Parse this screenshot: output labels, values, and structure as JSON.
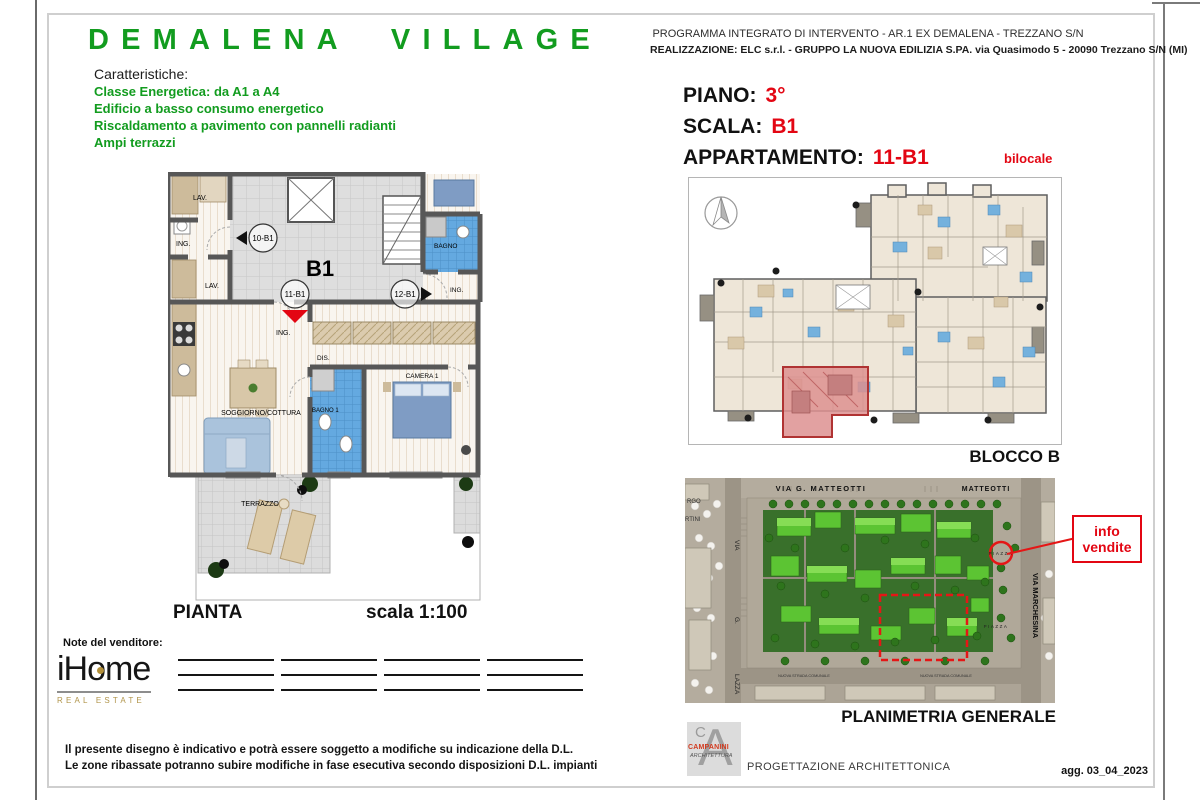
{
  "colors": {
    "brand_green": "#129c1f",
    "accent_red": "#e30613"
  },
  "brand": {
    "title": "DEMALENA VILLAGE",
    "caratteristiche_label": "Caratteristiche:",
    "features": [
      "Classe Energetica: da A1 a A4",
      "Edificio a basso consumo energetico",
      "Riscaldamento a pavimento con pannelli radianti",
      "Ampi terrazzi"
    ]
  },
  "header": {
    "line1": "PROGRAMMA INTEGRATO DI INTERVENTO -  AR.1 EX DEMALENA  - TREZZANO S/N",
    "line2": "REALIZZAZIONE: ELC s.r.l. - GRUPPO LA NUOVA EDILIZIA S.PA. via Quasimodo 5 - 20090 Trezzano S/N (MI)"
  },
  "unit_info": {
    "piano_label": "PIANO:",
    "piano_value": "3°",
    "scala_label": "SCALA:",
    "scala_value": "B1",
    "appartamento_label": "APPARTAMENTO:",
    "appartamento_value": "11-B1",
    "tipologia": "bilocale"
  },
  "floor_plan": {
    "caption": "PIANTA",
    "scale": "scala 1:100",
    "labels": {
      "block": "B1",
      "unit_10": "10-B1",
      "unit_11": "11-B1",
      "unit_12": "12-B1",
      "lav": "LAV.",
      "ing": "ING.",
      "dis": "DIS.",
      "bagno": "BAGNO",
      "bagno1": "BAGNO 1",
      "soggiorno": "SOGGIORNO/COTTURA",
      "camera1": "CAMERA 1",
      "terrazzo": "TERRAZZO"
    }
  },
  "blocco_b": {
    "caption": "BLOCCO B"
  },
  "site_plan": {
    "caption": "PLANIMETRIA GENERALE",
    "labels": {
      "via_matteotti": "VIA G. MATTEOTTI",
      "matteotti": "MATTEOTTI",
      "via_marchesina": "VIA MARCHESINA",
      "via": "VIA",
      "g": "G.",
      "lazza": "LAZZA",
      "rgo": "RGO",
      "rtini": "RTINI",
      "piazza": "PIAZZA",
      "strada": "NUOVA STRADA COMUNALE"
    },
    "info_vendite_line1": "info",
    "info_vendite_line2": "vendite"
  },
  "notes": {
    "label": "Note del venditore:"
  },
  "ihome": {
    "name": "iHome",
    "tagline": "REAL ESTATE"
  },
  "disclaimer": {
    "line1": "Il presente disegno è indicativo e potrà essere soggetto a modifiche su indicazione della D.L.",
    "line2": "Le zone ribassate potranno subire modifiche in fase esecutiva secondo disposizioni D.L. impianti"
  },
  "footer": {
    "progettazione": "PROGETTAZIONE ARCHITETTONICA",
    "aggiornamento": "agg. 03_04_2023",
    "campanini_name": "CAMPANINI",
    "campanini_arch": "ARCHITETTURA",
    "campanini_a": "A",
    "campanini_c": "C"
  }
}
